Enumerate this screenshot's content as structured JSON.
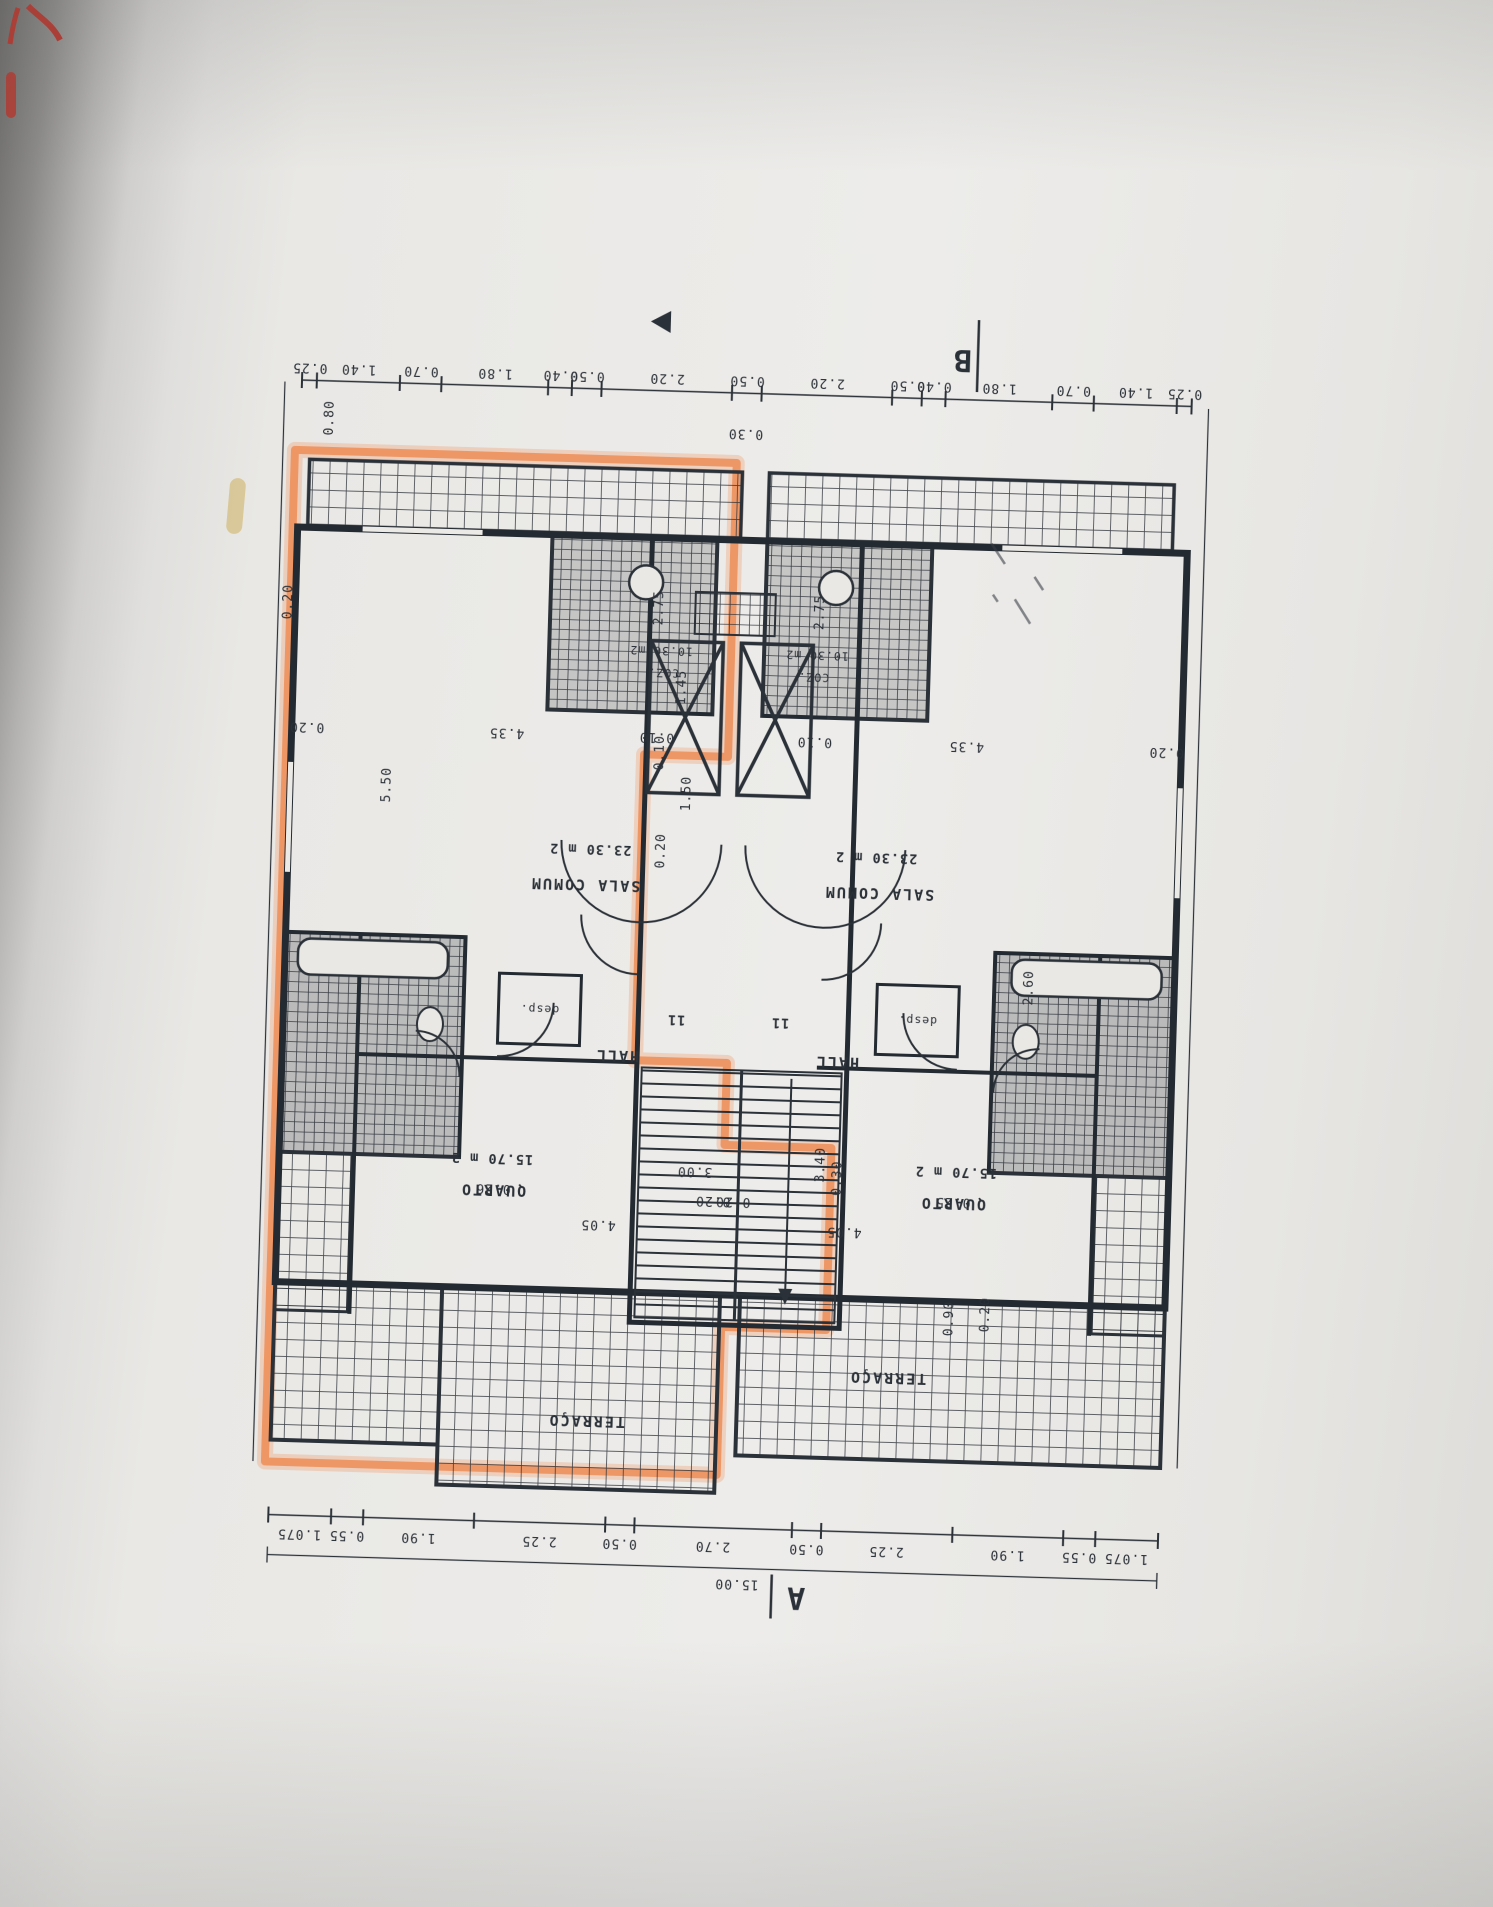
{
  "markers": {
    "section_a": "A",
    "section_b": "B"
  },
  "rooms": {
    "sala_comum": {
      "name": "SALA COMUM",
      "area": "23.30 m 2"
    },
    "quarto": {
      "name": "QUARTO",
      "area": "15.70 m 2"
    },
    "hall": {
      "name": "HALL",
      "number": "11"
    },
    "desp": {
      "name": "desp."
    },
    "terraco": {
      "name": "TERRAÇO"
    },
    "coz": {
      "name": "COZ.",
      "area": "10.30 m2"
    }
  },
  "dims": {
    "row_top": [
      "0.25",
      "1.40",
      "0.70",
      "1.80",
      "0.40",
      "0.50",
      "2.20",
      "0.50",
      "2.20",
      "0.50",
      "0.40",
      "1.80",
      "0.70",
      "1.40",
      "0.25"
    ],
    "row_bottom": [
      "1.075",
      "0.55",
      "1.90",
      "2.25",
      "0.50",
      "2.70",
      "0.50",
      "2.25",
      "1.90",
      "0.55",
      "1.075"
    ],
    "total": "15.00",
    "interior": [
      "0.20",
      "4.35",
      "0.10",
      "5.50",
      "0.80",
      "0.20",
      "2.75",
      "1.45",
      "0.10",
      "1.50",
      "0.20",
      "2.60",
      "3.40",
      "3.00",
      "0.90",
      "0.20",
      "4.05",
      "0.20",
      "0.26",
      "0.10",
      "4.35",
      "0.20",
      "2.75",
      "4.05",
      "0.25",
      "0.30",
      "0.20",
      "0.30"
    ]
  },
  "highlight": {
    "color": "#ef8a50"
  }
}
